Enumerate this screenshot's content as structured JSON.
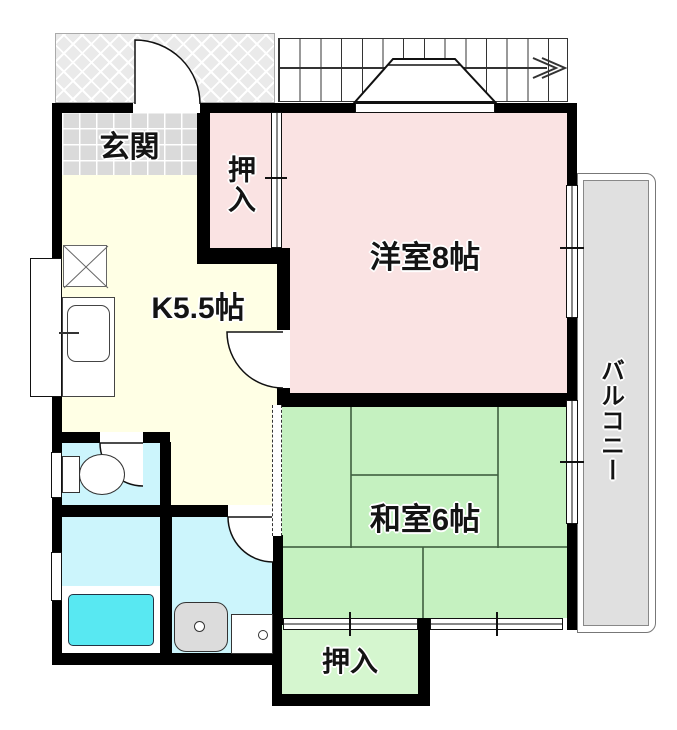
{
  "type": "floor-plan",
  "rooms": {
    "genkan": {
      "label": "玄関"
    },
    "closet_upper": {
      "label": "押入"
    },
    "western_room": {
      "label": "洋室8帖"
    },
    "kitchen": {
      "label": "K5.5帖"
    },
    "japanese_room": {
      "label": "和室6帖"
    },
    "closet_lower": {
      "label": "押入"
    },
    "balcony": {
      "label": "バルコニー"
    }
  },
  "colors": {
    "wall": "#000000",
    "western_room": "#FAE3E3",
    "closet_upper": "#FAE3E3",
    "japanese_room": "#C5F1C0",
    "closet_lower": "#D5F6CF",
    "kitchen": "#FFFFE5",
    "wet_room": "#CCF5FC",
    "bathtub": "#58E8F2",
    "entrance_tile": "#DADADA",
    "balcony": "#E0E0E0",
    "porch_hatch": "#EAEAEA"
  }
}
